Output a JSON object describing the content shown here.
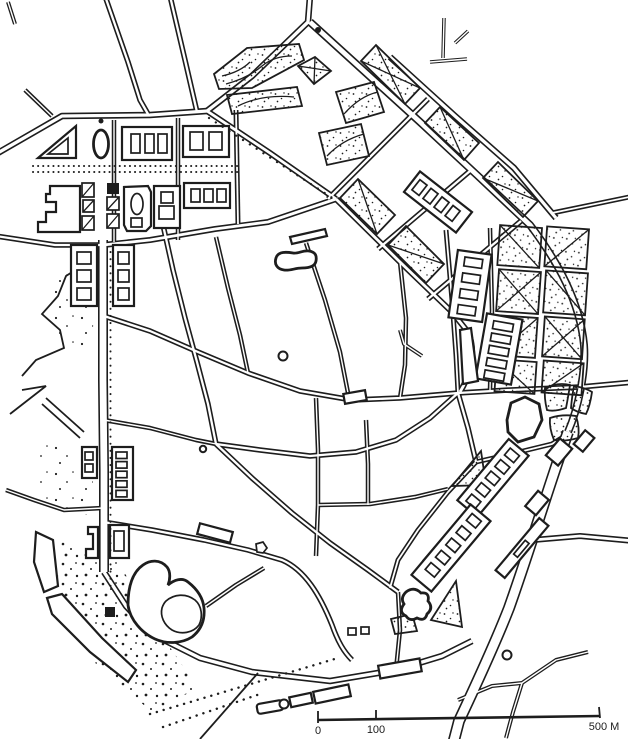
{
  "figure": {
    "kind": "scanned hand-drawn city plan, black ink line drawing on white paper",
    "ink_color": "#1d1d1d",
    "paper_color": "#ffffff"
  },
  "scale_bar": {
    "label_zero": "0",
    "label_mid": "100",
    "label_end": "500 M",
    "unit": "M"
  }
}
